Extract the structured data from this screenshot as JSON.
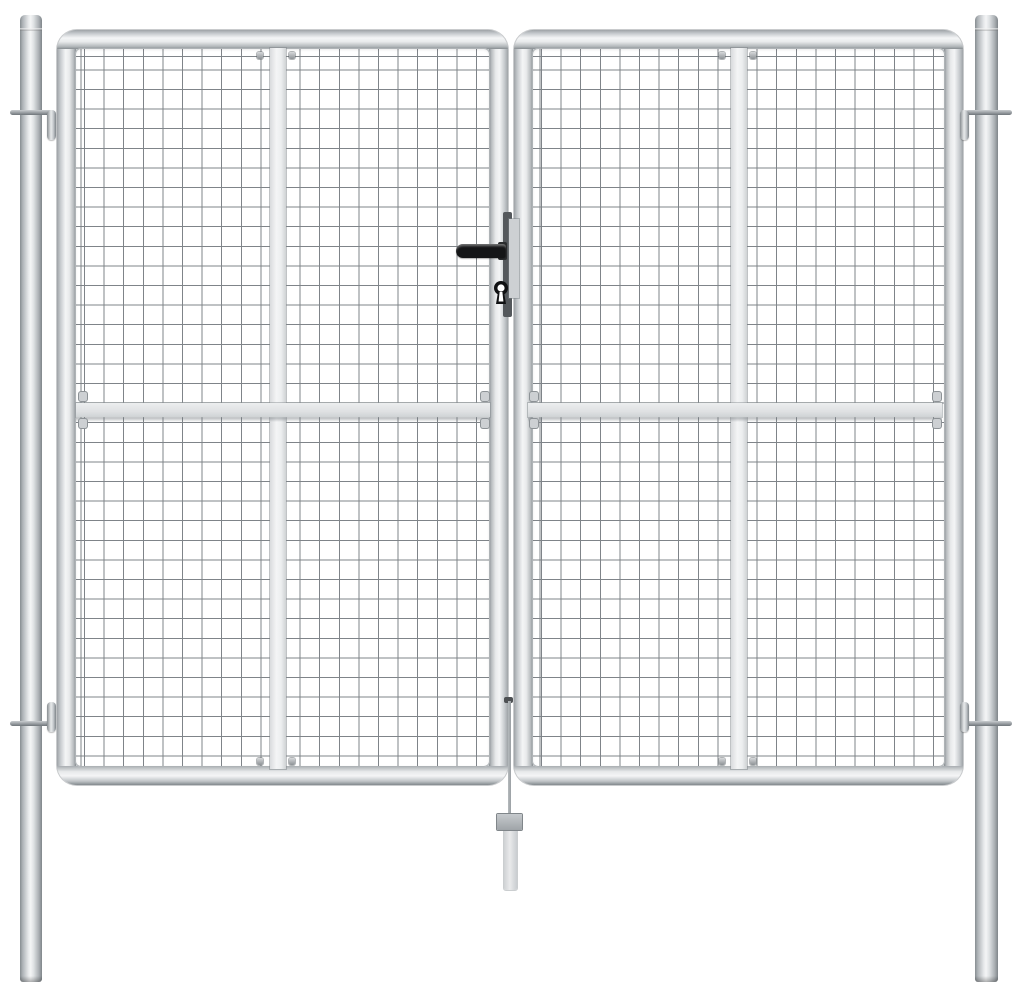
{
  "scene": {
    "type": "product-photo",
    "subject": "Silver galvanised steel double garden gate with square wire mesh infill, mounted between two round posts",
    "background_color": "#ffffff"
  },
  "colors": {
    "background": "#ffffff",
    "steel_highlight": "#f4f5f6",
    "steel_light": "#e8eaeb",
    "steel_mid": "#c6cacd",
    "steel_dark": "#878d91",
    "mesh_wire": "#7f8489",
    "strap": "#eceeef",
    "rail_shadow": "#6e747a",
    "handle_black": "#141517",
    "lock_plate_dark": "#54585c",
    "lock_plate_light": "#cdd0d3",
    "rod": "#9aa0a4",
    "sleeve_light": "#e9eaeb"
  },
  "parts": {
    "left_post": "Left round mounting post with cap seam",
    "right_post": "Right round mounting post with cap seam",
    "left_leaf": "Left gate leaf with tubular frame and wire mesh panel",
    "right_leaf": "Right gate leaf with tubular frame and wire mesh panel",
    "left_mesh": "Welded square wire mesh infill of left leaf",
    "right_mesh": "Welded square wire mesh infill of right leaf",
    "left_strap": "Vertical flat reinforcement strap on left leaf",
    "right_strap": "Vertical flat reinforcement strap on right leaf",
    "left_rail": "Horizontal flat mid rail across left leaf",
    "right_rail": "Horizontal flat mid rail across right leaf",
    "handle": "Black lever door handle on centre stile",
    "lock_plate_dark": "Dark lock mounting plate between the leaves",
    "lock_plate_light": "Light lock cover plate on right leaf stile",
    "keyhole": "Keyhole below the lever handle",
    "hinge_top_left": "Upper left hinge pin through post",
    "hinge_bottom_left": "Lower left hinge pin through post",
    "hinge_top_right": "Upper right hinge pin through post",
    "hinge_bottom_right": "Lower right hinge pin through post",
    "drop_rod": "Centre drop bolt rod with bent handle",
    "drop_block": "Drop bolt guide block",
    "ground_sleeve": "Ground sleeve tube for drop bolt"
  }
}
